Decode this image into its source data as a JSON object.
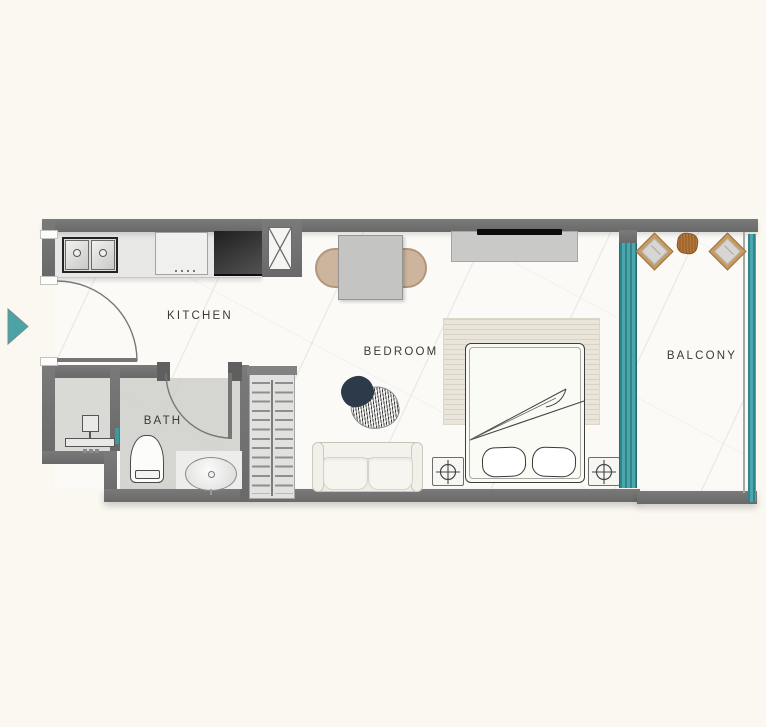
{
  "rooms": {
    "kitchen": {
      "label": "KITCHEN"
    },
    "bedroom": {
      "label": "BEDROOM"
    },
    "bath": {
      "label": "BATH"
    },
    "balcony": {
      "label": "BALCONY"
    }
  },
  "colors": {
    "background": "#faf8f1",
    "wall": "#6f6f6f",
    "teal_accent": "#4aa2a7",
    "teal_dark": "#2e858b",
    "floor_light": "#fbfaf7",
    "floor_bath": "#d5d5d2",
    "counter": "#e7e7e5",
    "wood_tan": "#c59a63",
    "navy_blob": "#2d3a49"
  },
  "icons": {
    "entrance-arrow": "teal triangle pointing right",
    "kitchen-sink": "double basin with faucets",
    "stove": "four burner cooktop",
    "counter-appliance": "dark built-in unit",
    "duct-shaft": "box with X",
    "door-swing": "quarter-circle arc",
    "dining-table": "square table with two chairs",
    "tv": "black bar on console",
    "double-bed": "bed with two pillows and folded blanket",
    "nightstand-lamp": "circle with crosshair",
    "sofa": "two-seat sofa",
    "coffee-table": "organic blob tables",
    "wardrobe-hangers": "closet with hanger rows",
    "toilet": "top-view toilet",
    "bathroom-sink": "oval basin",
    "water-heater": "box with bar",
    "sliding-glass-door": "striped teal strip",
    "balcony-railing": "teal rail",
    "balcony-chair": "rotated square chair",
    "balcony-table": "round wood table"
  }
}
